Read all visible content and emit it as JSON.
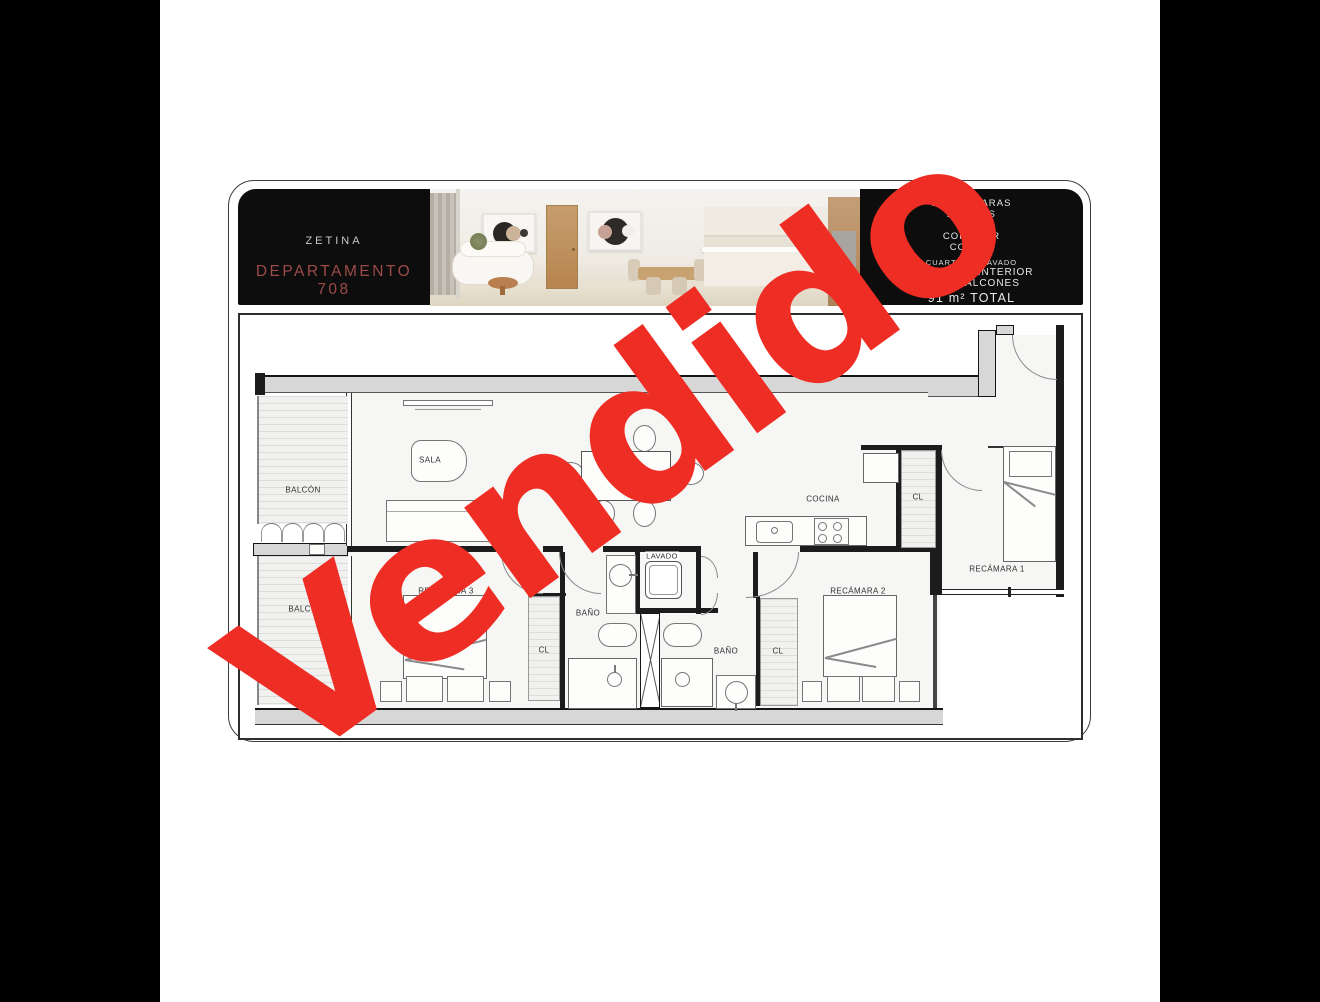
{
  "watermark": {
    "text": "Vendido",
    "color": "#ee2d24"
  },
  "header": {
    "brand": "ZETINA",
    "title_line1": "DEPARTAMENTO",
    "title_line2": "708",
    "title_color": "#9c4b47",
    "specs": [
      "3 RECÁMARAS",
      "2 BAÑOS",
      "SALA",
      "COMEDOR",
      "COCINA"
    ],
    "laundry_line": "CUARTO DE LAVADO",
    "area_lines": [
      "81 m² AREA INTERIOR",
      "10 m² BALCONES"
    ],
    "total_line": "91 m² TOTAL"
  },
  "plan": {
    "rooms": [
      {
        "label": "BALCÓN"
      },
      {
        "label": "SALA"
      },
      {
        "label": "COMEDOR"
      },
      {
        "label": "COCINA"
      },
      {
        "label": "CL"
      },
      {
        "label": "RECÁMARA 1"
      },
      {
        "label": "BALCÓN"
      },
      {
        "label": "RECÁMARA 3"
      },
      {
        "label": "BAÑO"
      },
      {
        "label": "CL"
      },
      {
        "label": "LAVADO"
      },
      {
        "label": "BAÑO"
      },
      {
        "label": "CL"
      },
      {
        "label": "RECÁMARA 2"
      }
    ]
  }
}
